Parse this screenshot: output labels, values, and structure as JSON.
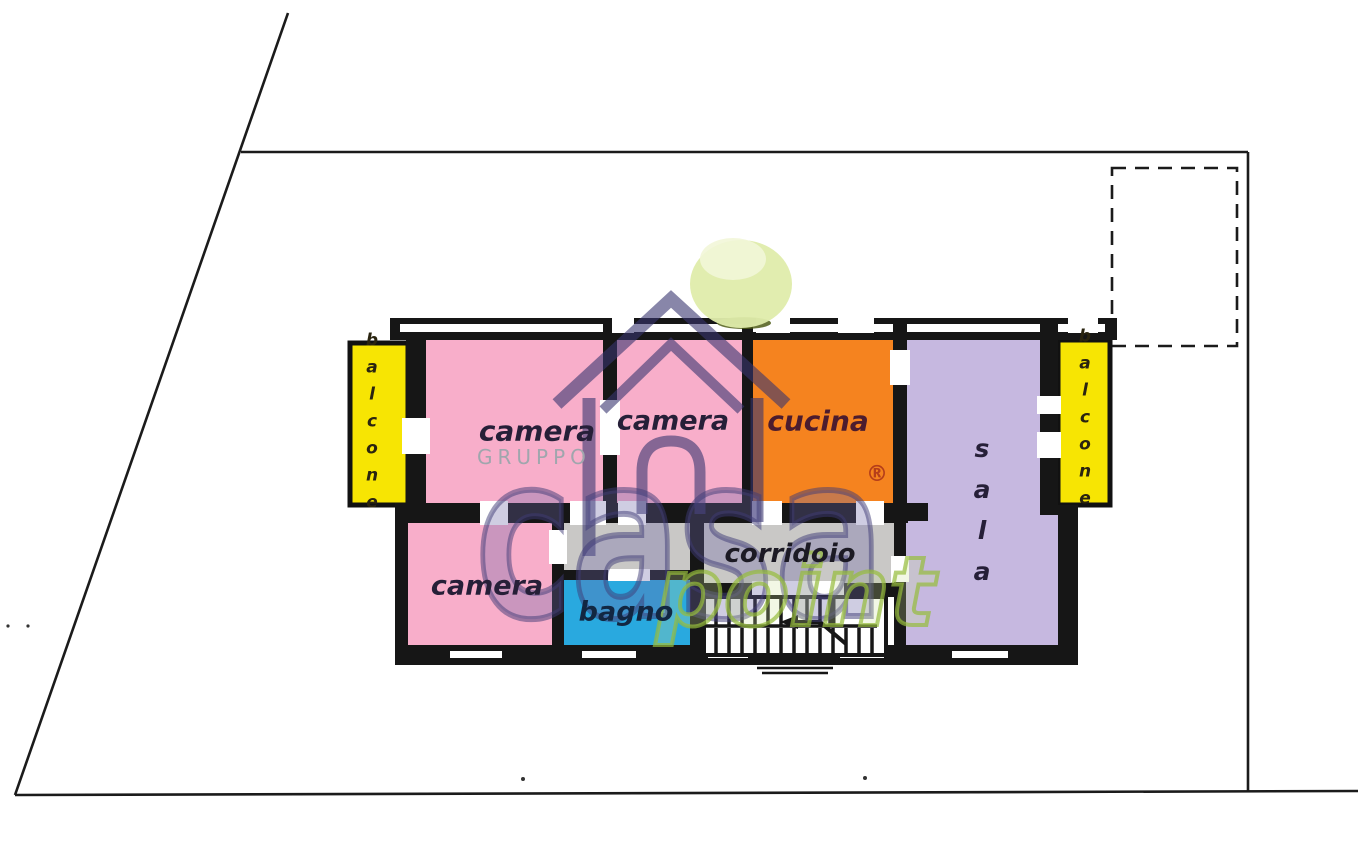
{
  "plan": {
    "rooms": {
      "camera_top_left": "camera",
      "camera_top_middle": "camera",
      "camera_bottom_left": "camera",
      "cucina": "cucina",
      "sala": "sala",
      "corridoio": "corridoio",
      "bagno": "bagno",
      "balcone_left": "balcone",
      "balcone_right": "balcone"
    }
  },
  "watermark": {
    "gruppo": "GRUPPO",
    "brand": "casa",
    "brand_suffix": "point",
    "registered_mark": "®"
  },
  "colors": {
    "bedroom_pink": "#F8AECA",
    "kitchen_orange": "#F5831F",
    "living_purple": "#C6B8E0",
    "balcony_yellow": "#F7E503",
    "bath_blue": "#29A9DF",
    "hall_gray": "#C9C8C6",
    "wall_black": "#161616",
    "boundary_black": "#1B1B1B",
    "ball_green": "#DFECAB",
    "ball_highlight": "#F2F6D8",
    "ball_shadow_olive": "#4F5D17",
    "gruppo_gray": "#A0A6AD"
  }
}
